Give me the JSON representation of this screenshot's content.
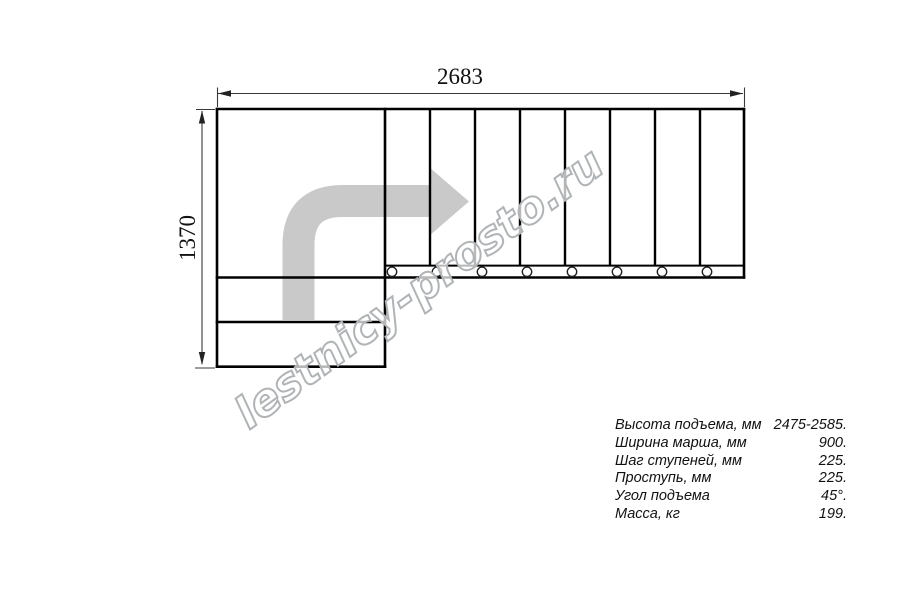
{
  "diagram": {
    "title": "L-shaped staircase plan view",
    "width_dimension": "2683",
    "height_dimension": "1370",
    "upper_flight_steps": 8,
    "lower_flight_steps": 2,
    "bolt_circles": 8
  },
  "watermark": "lestnicy-prosto.ru",
  "specs": {
    "rows": [
      {
        "label": "Высота подъема, мм",
        "value": "2475-2585."
      },
      {
        "label": "Ширина марша, мм",
        "value": "900."
      },
      {
        "label": "Шаг ступеней, мм",
        "value": "225."
      },
      {
        "label": "Проступь, мм",
        "value": "225."
      },
      {
        "label": "Угол подъема",
        "value": "45°."
      },
      {
        "label": "Масса, кг",
        "value": "199."
      }
    ]
  },
  "colors": {
    "outline": "#000000",
    "dimension": "#3a3a3a",
    "arrow_fill": "#c9c9c9",
    "watermark_outline": "#b1b4b6"
  }
}
